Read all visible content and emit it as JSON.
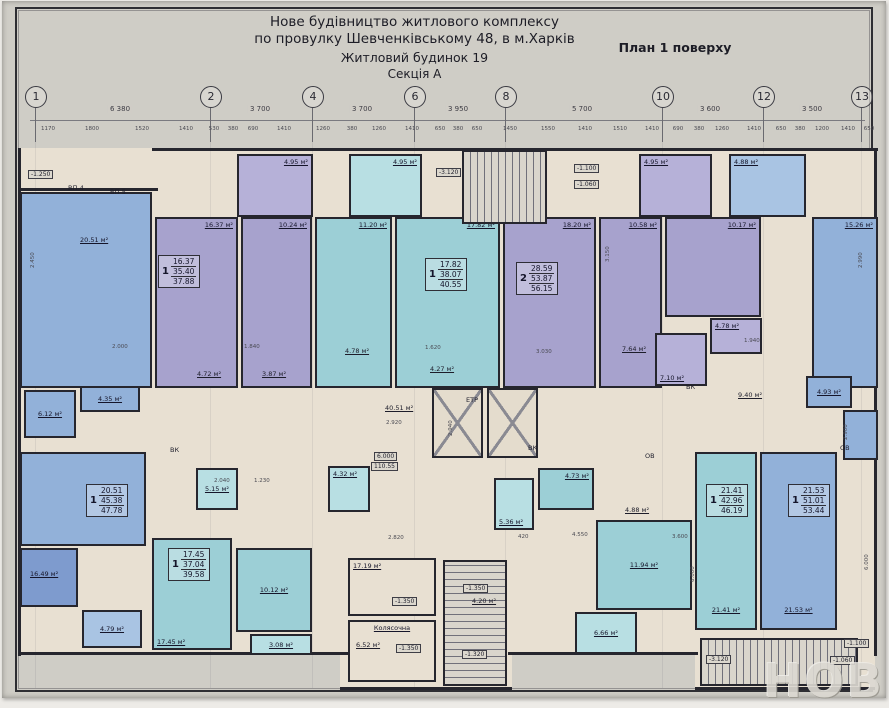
{
  "header": {
    "line1": "Нове будівництво житлового комплексу",
    "line2": "по провулку Шевченківському 48, в м.Харків",
    "line3": "Житловий будинок 19",
    "line4": "Секція А",
    "plan_label": "План 1 поверху"
  },
  "watermark": "НОВ",
  "colors": {
    "wall": "#26262e",
    "beige": "#e8e0d2",
    "purple": "#a7a2cd",
    "purpleLight": "#b6b1d8",
    "teal": "#9ccfd6",
    "tealLight": "#b8dfe3",
    "blue": "#92b1d9",
    "blueDark": "#7e9bce",
    "blueLight": "#a9c4e3"
  },
  "axes": {
    "circles": [
      {
        "n": "1",
        "x": 35
      },
      {
        "n": "2",
        "x": 210
      },
      {
        "n": "4",
        "x": 312
      },
      {
        "n": "6",
        "x": 414
      },
      {
        "n": "8",
        "x": 505
      },
      {
        "n": "10",
        "x": 662
      },
      {
        "n": "12",
        "x": 763
      },
      {
        "n": "13",
        "x": 861
      }
    ],
    "spans": [
      {
        "x": 120,
        "t": "6 380"
      },
      {
        "x": 260,
        "t": "3 700"
      },
      {
        "x": 362,
        "t": "3 700"
      },
      {
        "x": 458,
        "t": "3 950"
      },
      {
        "x": 582,
        "t": "5 700"
      },
      {
        "x": 710,
        "t": "3 600"
      },
      {
        "x": 812,
        "t": "3 500"
      }
    ],
    "dims_top": [
      {
        "x": 48,
        "t": "1170"
      },
      {
        "x": 92,
        "t": "1800"
      },
      {
        "x": 142,
        "t": "1520"
      },
      {
        "x": 186,
        "t": "1410"
      },
      {
        "x": 214,
        "t": "530"
      },
      {
        "x": 233,
        "t": "380"
      },
      {
        "x": 253,
        "t": "690"
      },
      {
        "x": 284,
        "t": "1410"
      },
      {
        "x": 323,
        "t": "1260"
      },
      {
        "x": 352,
        "t": "380"
      },
      {
        "x": 379,
        "t": "1260"
      },
      {
        "x": 412,
        "t": "1410"
      },
      {
        "x": 440,
        "t": "650"
      },
      {
        "x": 458,
        "t": "380"
      },
      {
        "x": 477,
        "t": "650"
      },
      {
        "x": 510,
        "t": "1450"
      },
      {
        "x": 548,
        "t": "1550"
      },
      {
        "x": 585,
        "t": "1410"
      },
      {
        "x": 620,
        "t": "1510"
      },
      {
        "x": 652,
        "t": "1410"
      },
      {
        "x": 678,
        "t": "690"
      },
      {
        "x": 699,
        "t": "380"
      },
      {
        "x": 722,
        "t": "1260"
      },
      {
        "x": 754,
        "t": "1410"
      },
      {
        "x": 781,
        "t": "650"
      },
      {
        "x": 800,
        "t": "380"
      },
      {
        "x": 822,
        "t": "1200"
      },
      {
        "x": 848,
        "t": "1410"
      },
      {
        "x": 869,
        "t": "650"
      }
    ]
  },
  "plan": {
    "base": [
      {
        "x": 18,
        "y": 148,
        "w": 859,
        "h": 507
      },
      {
        "x": 340,
        "y": 560,
        "w": 172,
        "h": 130
      },
      {
        "x": 695,
        "y": 600,
        "w": 180,
        "h": 90
      }
    ],
    "walls": [
      {
        "x": 18,
        "y": 148,
        "w": 3,
        "h": 508
      },
      {
        "x": 874,
        "y": 148,
        "w": 3,
        "h": 508
      },
      {
        "x": 152,
        "y": 148,
        "w": 726,
        "h": 3
      },
      {
        "x": 18,
        "y": 188,
        "w": 140,
        "h": 3
      },
      {
        "x": 18,
        "y": 652,
        "w": 330,
        "h": 3
      },
      {
        "x": 508,
        "y": 652,
        "w": 190,
        "h": 3
      },
      {
        "x": 340,
        "y": 687,
        "w": 172,
        "h": 3
      },
      {
        "x": 695,
        "y": 687,
        "w": 180,
        "h": 3
      }
    ],
    "rooms": [
      {
        "name": "balcony-495-a",
        "x": 237,
        "y": 154,
        "w": 76,
        "h": 63,
        "c": "purpleLight",
        "label": "4.95 м²",
        "pos": "tr"
      },
      {
        "name": "balcony-495-b",
        "x": 349,
        "y": 154,
        "w": 73,
        "h": 63,
        "c": "tealLight",
        "label": "4.95 м²",
        "pos": "tr"
      },
      {
        "name": "balcony-495-c",
        "x": 639,
        "y": 154,
        "w": 73,
        "h": 63,
        "c": "purpleLight",
        "label": "4.95 м²",
        "pos": "tl"
      },
      {
        "name": "balcony-488",
        "x": 729,
        "y": 154,
        "w": 77,
        "h": 63,
        "c": "blueLight",
        "label": "4.88 м²",
        "pos": "tl"
      },
      {
        "name": "room-2051-top",
        "x": 20,
        "y": 192,
        "w": 132,
        "h": 196,
        "c": "blue",
        "label": "20.51 м²",
        "lx": 58,
        "ly": 42
      },
      {
        "name": "room-1637",
        "x": 155,
        "y": 217,
        "w": 83,
        "h": 171,
        "c": "purple",
        "label": "16.37 м²",
        "pos": "tr"
      },
      {
        "name": "room-1024",
        "x": 241,
        "y": 217,
        "w": 71,
        "h": 171,
        "c": "purple",
        "label": "10.24 м²",
        "pos": "tr"
      },
      {
        "name": "room-1120",
        "x": 315,
        "y": 217,
        "w": 77,
        "h": 171,
        "c": "teal",
        "label": "11.20 м²",
        "pos": "tr"
      },
      {
        "name": "room-1782",
        "x": 395,
        "y": 217,
        "w": 105,
        "h": 171,
        "c": "teal",
        "label": "17.82 м²",
        "pos": "tr"
      },
      {
        "name": "room-1820",
        "x": 503,
        "y": 217,
        "w": 93,
        "h": 171,
        "c": "purple",
        "label": "18.20 м²",
        "pos": "tr"
      },
      {
        "name": "room-1058",
        "x": 599,
        "y": 217,
        "w": 63,
        "h": 171,
        "c": "purple",
        "label": "10.58 м²",
        "pos": "tr"
      },
      {
        "name": "room-1017",
        "x": 665,
        "y": 217,
        "w": 96,
        "h": 100,
        "c": "purple",
        "label": "10.17 м²",
        "pos": "tr"
      },
      {
        "name": "room-1526",
        "x": 812,
        "y": 217,
        "w": 66,
        "h": 171,
        "c": "blue",
        "label": "15.26 м²",
        "pos": "tr"
      },
      {
        "name": "room-710",
        "x": 655,
        "y": 333,
        "w": 52,
        "h": 53,
        "c": "purpleLight",
        "label": "7.10 м²",
        "pos": "bl"
      },
      {
        "name": "room-478-top",
        "x": 710,
        "y": 318,
        "w": 52,
        "h": 36,
        "c": "purpleLight",
        "label": "4.78 м²",
        "pos": "tl"
      },
      {
        "name": "room-612",
        "x": 24,
        "y": 390,
        "w": 52,
        "h": 48,
        "c": "blue",
        "label": "6.12 м²",
        "pos": "c"
      },
      {
        "name": "room-435",
        "x": 80,
        "y": 386,
        "w": 60,
        "h": 26,
        "c": "blue",
        "label": "4.35 м²",
        "pos": "c"
      },
      {
        "name": "room-493",
        "x": 806,
        "y": 376,
        "w": 46,
        "h": 32,
        "c": "blue",
        "label": "4.93 м²",
        "pos": "c"
      },
      {
        "name": "room-right-bath",
        "x": 843,
        "y": 410,
        "w": 35,
        "h": 50,
        "c": "blue"
      },
      {
        "name": "room-2051-bottom",
        "x": 20,
        "y": 452,
        "w": 126,
        "h": 94,
        "c": "blue"
      },
      {
        "name": "room-1649",
        "x": 20,
        "y": 548,
        "w": 58,
        "h": 59,
        "c": "blueDark",
        "label": "16.49 м²",
        "lx": 8,
        "ly": 20
      },
      {
        "name": "room-479",
        "x": 82,
        "y": 610,
        "w": 60,
        "h": 38,
        "c": "blueLight",
        "label": "4.79 м²",
        "pos": "c"
      },
      {
        "name": "room-1745",
        "x": 152,
        "y": 538,
        "w": 80,
        "h": 112,
        "c": "teal",
        "label": "17.45 м²",
        "pos": "bl"
      },
      {
        "name": "room-1012",
        "x": 236,
        "y": 548,
        "w": 76,
        "h": 84,
        "c": "teal",
        "label": "10.12 м²",
        "pos": "c"
      },
      {
        "name": "room-308",
        "x": 250,
        "y": 634,
        "w": 62,
        "h": 21,
        "c": "tealLight",
        "label": "3.08 м²",
        "pos": "c"
      },
      {
        "name": "room-515",
        "x": 196,
        "y": 468,
        "w": 42,
        "h": 42,
        "c": "tealLight",
        "label": "5.15 м²",
        "pos": "c"
      },
      {
        "name": "room-432",
        "x": 328,
        "y": 466,
        "w": 42,
        "h": 46,
        "c": "tealLight",
        "label": "4.32 м²",
        "pos": "tl"
      },
      {
        "name": "room-536",
        "x": 494,
        "y": 478,
        "w": 40,
        "h": 52,
        "c": "tealLight",
        "label": "5.36 м²",
        "pos": "bl"
      },
      {
        "name": "room-473",
        "x": 538,
        "y": 468,
        "w": 56,
        "h": 42,
        "c": "teal",
        "label": "4.73 м²",
        "pos": "tr"
      },
      {
        "name": "room-1194",
        "x": 596,
        "y": 520,
        "w": 96,
        "h": 90,
        "c": "teal",
        "label": "11.94 м²",
        "pos": "c"
      },
      {
        "name": "room-666",
        "x": 575,
        "y": 612,
        "w": 62,
        "h": 42,
        "c": "tealLight",
        "label": "6.66 м²",
        "pos": "c"
      },
      {
        "name": "room-2141",
        "x": 695,
        "y": 452,
        "w": 62,
        "h": 178,
        "c": "teal",
        "label": "21.41 м²",
        "pos": "bc"
      },
      {
        "name": "room-2153",
        "x": 760,
        "y": 452,
        "w": 77,
        "h": 178,
        "c": "blue",
        "label": "21.53 м²",
        "pos": "bc"
      },
      {
        "name": "vestibule-1719",
        "x": 348,
        "y": 558,
        "w": 88,
        "h": 58,
        "c": "beige",
        "label": "17.19 м²",
        "pos": "tl"
      },
      {
        "name": "room-koliasochna",
        "x": 348,
        "y": 620,
        "w": 88,
        "h": 62,
        "c": "beige",
        "label": "Колясочна",
        "pos": "tc"
      }
    ],
    "stairs": [
      {
        "name": "stairs-top",
        "x": 462,
        "y": 150,
        "w": 85,
        "h": 74,
        "dir": "v"
      },
      {
        "name": "stairs-bottom-center",
        "x": 443,
        "y": 560,
        "w": 64,
        "h": 126,
        "dir": "h"
      },
      {
        "name": "stairs-bottom-right",
        "x": 700,
        "y": 638,
        "w": 158,
        "h": 48,
        "dir": "v"
      }
    ],
    "lifts": [
      {
        "name": "elevator-left",
        "x": 432,
        "y": 388,
        "w": 51,
        "h": 70
      },
      {
        "name": "elevator-right",
        "x": 487,
        "y": 388,
        "w": 51,
        "h": 70
      }
    ],
    "stamps": [
      {
        "x": 158,
        "y": 255,
        "type": "1",
        "l1": "16.37",
        "l2": "35.40",
        "l3": "37.88"
      },
      {
        "x": 425,
        "y": 258,
        "type": "1",
        "l1": "17.82",
        "l2": "38.07",
        "l3": "40.55"
      },
      {
        "x": 516,
        "y": 262,
        "type": "2",
        "l1": "28.59",
        "l2": "53.87",
        "l3": "56.15"
      },
      {
        "x": 86,
        "y": 484,
        "type": "1",
        "l1": "20.51",
        "l2": "45.38",
        "l3": "47.78"
      },
      {
        "x": 168,
        "y": 548,
        "type": "1",
        "l1": "17.45",
        "l2": "37.04",
        "l3": "39.58"
      },
      {
        "x": 706,
        "y": 484,
        "type": "1",
        "l1": "21.41",
        "l2": "42.96",
        "l3": "46.19"
      },
      {
        "x": 788,
        "y": 484,
        "type": "1",
        "l1": "21.53",
        "l2": "51.01",
        "l3": "53.44"
      }
    ],
    "texts": [
      {
        "x": 28,
        "y": 170,
        "t": "-1.250",
        "box": true
      },
      {
        "x": 68,
        "y": 184,
        "t": "ВП-4"
      },
      {
        "x": 110,
        "y": 188,
        "t": "ВП-5"
      },
      {
        "x": 436,
        "y": 168,
        "t": "-3.120",
        "box": true
      },
      {
        "x": 574,
        "y": 164,
        "t": "-1.100",
        "box": true
      },
      {
        "x": 574,
        "y": 180,
        "t": "-1.060",
        "box": true
      },
      {
        "x": 345,
        "y": 347,
        "t": "4.78 м²"
      },
      {
        "x": 430,
        "y": 365,
        "t": "4.27 м²"
      },
      {
        "x": 197,
        "y": 370,
        "t": "4.72 м²"
      },
      {
        "x": 262,
        "y": 370,
        "t": "3.87 м²"
      },
      {
        "x": 622,
        "y": 345,
        "t": "7.64 м²"
      },
      {
        "x": 385,
        "y": 404,
        "t": "40.51 м²"
      },
      {
        "x": 386,
        "y": 420,
        "t": "2.920",
        "dim": true
      },
      {
        "x": 466,
        "y": 396,
        "t": "ЕТР"
      },
      {
        "x": 170,
        "y": 446,
        "t": "ВК"
      },
      {
        "x": 528,
        "y": 444,
        "t": "ВК"
      },
      {
        "x": 686,
        "y": 383,
        "t": "ВК"
      },
      {
        "x": 645,
        "y": 452,
        "t": "ОВ"
      },
      {
        "x": 840,
        "y": 444,
        "t": "ОВ"
      },
      {
        "x": 738,
        "y": 391,
        "t": "9.40 м²"
      },
      {
        "x": 374,
        "y": 452,
        "t": "6.000",
        "box": true
      },
      {
        "x": 371,
        "y": 462,
        "t": "110.55",
        "box": true
      },
      {
        "x": 392,
        "y": 597,
        "t": "-1.350",
        "box": true
      },
      {
        "x": 356,
        "y": 641,
        "t": "6.52 м²"
      },
      {
        "x": 396,
        "y": 644,
        "t": "-1.350",
        "box": true
      },
      {
        "x": 463,
        "y": 584,
        "t": "-1.350",
        "box": true
      },
      {
        "x": 472,
        "y": 597,
        "t": "4.20 м²"
      },
      {
        "x": 462,
        "y": 650,
        "t": "-1.320",
        "box": true
      },
      {
        "x": 706,
        "y": 655,
        "t": "-3.120",
        "box": true
      },
      {
        "x": 844,
        "y": 639,
        "t": "-1.100",
        "box": true
      },
      {
        "x": 830,
        "y": 656,
        "t": "-1.060",
        "box": true
      },
      {
        "x": 625,
        "y": 506,
        "t": "4.88 м²"
      },
      {
        "x": 112,
        "y": 344,
        "t": "2.000",
        "dim": true
      },
      {
        "x": 244,
        "y": 344,
        "t": "1.840",
        "dim": true
      },
      {
        "x": 425,
        "y": 345,
        "t": "1.620",
        "dim": true
      },
      {
        "x": 536,
        "y": 349,
        "t": "3.030",
        "dim": true
      },
      {
        "x": 744,
        "y": 338,
        "t": "1.940",
        "dim": true
      },
      {
        "x": 214,
        "y": 478,
        "t": "2.040",
        "dim": true
      },
      {
        "x": 254,
        "y": 478,
        "t": "1.230",
        "dim": true
      },
      {
        "x": 518,
        "y": 534,
        "t": "420",
        "dim": true
      },
      {
        "x": 572,
        "y": 532,
        "t": "4.550",
        "dim": true
      },
      {
        "x": 672,
        "y": 534,
        "t": "3.600",
        "dim": true
      },
      {
        "x": 388,
        "y": 535,
        "t": "2.820",
        "dim": true
      },
      {
        "x": 30,
        "y": 268,
        "t": "2.450",
        "rot": true,
        "dim": true
      },
      {
        "x": 858,
        "y": 268,
        "t": "2.990",
        "rot": true,
        "dim": true
      },
      {
        "x": 864,
        "y": 570,
        "t": "6.000",
        "rot": true,
        "dim": true
      },
      {
        "x": 690,
        "y": 582,
        "t": "6.000",
        "rot": true,
        "dim": true
      },
      {
        "x": 448,
        "y": 436,
        "t": "2.940",
        "rot": true,
        "dim": true
      },
      {
        "x": 605,
        "y": 262,
        "t": "3.150",
        "rot": true,
        "dim": true
      },
      {
        "x": 843,
        "y": 440,
        "t": "2.900",
        "rot": true,
        "dim": true
      }
    ]
  }
}
